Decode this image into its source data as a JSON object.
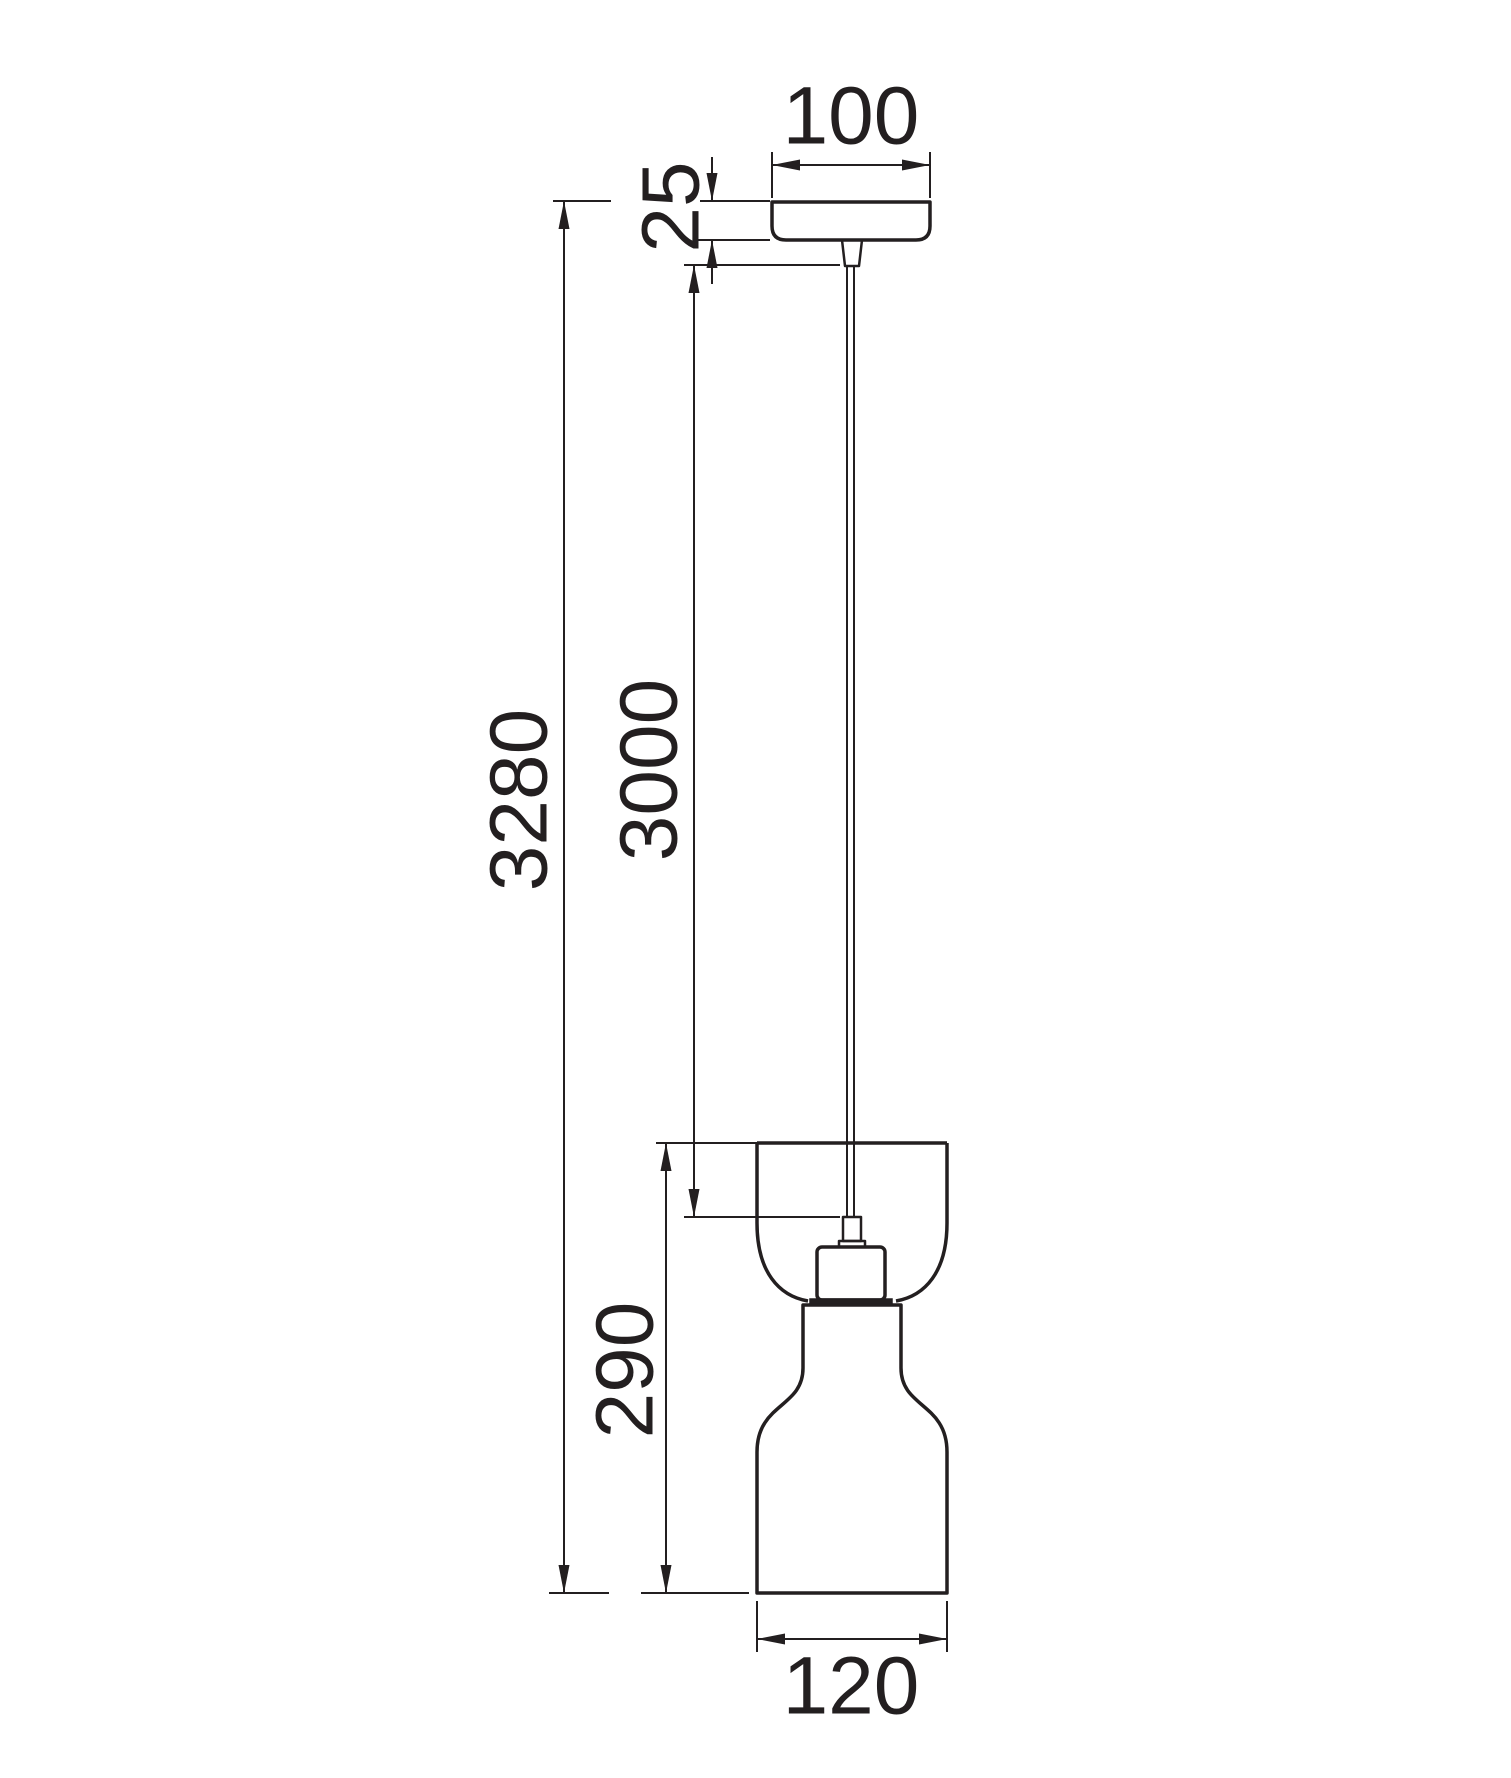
{
  "drawing": {
    "kind": "pendant-light-dimension-diagram",
    "colors": {
      "line": "#231f20",
      "background": "#ffffff"
    },
    "labels": {
      "canopy_width": "100",
      "canopy_height": "25",
      "suspension_length": "3000",
      "overall_height": "3280",
      "shade_height": "290",
      "shade_diameter": "120"
    }
  }
}
